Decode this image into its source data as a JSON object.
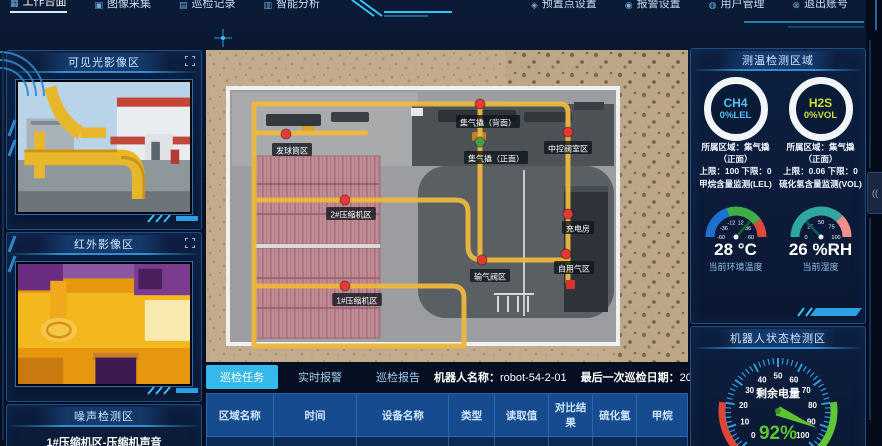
{
  "colors": {
    "accent": "#35c3f5",
    "marker_red": "#e53935",
    "marker_green": "#43a047",
    "path_yellow": "#edb83d",
    "ok_dot": "#8bc34a",
    "ch4": "#4fc3f7",
    "h2s": "#cddc39",
    "battery_green": "#5cc431"
  },
  "nav": {
    "items": [
      {
        "label": "工作台面",
        "icon": "▦",
        "active": true
      },
      {
        "label": "图像采集",
        "icon": "▣",
        "active": false
      },
      {
        "label": "巡检记录",
        "icon": "▤",
        "active": false
      },
      {
        "label": "智能分析",
        "icon": "▥",
        "active": false
      },
      {
        "label": "预置点设置",
        "icon": "◈",
        "active": false
      },
      {
        "label": "报警设置",
        "icon": "◉",
        "active": false
      },
      {
        "label": "用户管理",
        "icon": "◍",
        "active": false
      },
      {
        "label": "退出账号",
        "icon": "⊗",
        "active": false
      }
    ]
  },
  "left": {
    "visible_panel": {
      "title": "可见光影像区",
      "expand_icon": "fullscreen-icon"
    },
    "infrared_panel": {
      "title": "红外影像区",
      "expand_icon": "fullscreen-icon"
    },
    "noise_panel": {
      "title": "噪声检测区",
      "source": "1#压缩机区-压缩机声音"
    }
  },
  "map": {
    "markers": [
      {
        "label": "集气撬（背面）",
        "color": "#e53935",
        "type": "dot",
        "dot": [
          274,
          54
        ],
        "lab": [
          282,
          72
        ]
      },
      {
        "label": "集气撬（正面）",
        "color": "#43a047",
        "type": "dot",
        "dot": [
          274,
          92
        ],
        "lab": [
          290,
          108
        ]
      },
      {
        "label": "中控阀室区",
        "color": "#e53935",
        "type": "dot",
        "dot": [
          362,
          82
        ],
        "lab": [
          362,
          98
        ]
      },
      {
        "label": "发球筒区",
        "color": "#e53935",
        "type": "dot",
        "dot": [
          80,
          84
        ],
        "lab": [
          86,
          100
        ]
      },
      {
        "label": "2#压缩机区",
        "color": "#e53935",
        "type": "dot",
        "dot": [
          139,
          150
        ],
        "lab": [
          145,
          164
        ]
      },
      {
        "label": "1#压缩机区",
        "color": "#e53935",
        "type": "dot",
        "dot": [
          139,
          236
        ],
        "lab": [
          151,
          250
        ]
      },
      {
        "label": "充电房",
        "color": "#e53935",
        "type": "dot",
        "dot": [
          362,
          164
        ],
        "lab": [
          372,
          178
        ]
      },
      {
        "label": "自用气区",
        "color": "#e53935",
        "type": "dot",
        "dot": [
          360,
          204
        ],
        "lab": [
          368,
          218
        ]
      },
      {
        "label": "输气阀区",
        "color": "#e53935",
        "type": "dot",
        "dot": [
          276,
          210
        ],
        "lab": [
          284,
          226
        ]
      },
      {
        "label": "",
        "color": "#d63230",
        "type": "square",
        "dot": [
          364,
          234
        ],
        "lab": [
          0,
          0
        ]
      }
    ]
  },
  "tabs": {
    "items": [
      {
        "label": "巡检任务",
        "active": true
      },
      {
        "label": "实时报警",
        "active": false
      },
      {
        "label": "巡检报告",
        "active": false
      }
    ],
    "robot_name_label": "机器人名称：",
    "robot_name": "robot-54-2-01",
    "last_label": "最后一次巡检日期：",
    "last_date": "2019/6/8 10:07:44"
  },
  "table": {
    "headers": [
      "区域名称",
      "时间",
      "设备名称",
      "类型",
      "读取值",
      "对比结果",
      "硫化氢",
      "甲烷"
    ],
    "rows": [
      {
        "cells": [
          "集气撬（正面）",
          "2019-06-08 10:07:44",
          "集气撬自用气压力表",
          "图像识别",
          "3.38MPa",
          "ok-dot",
          "0",
          "0"
        ]
      }
    ]
  },
  "right": {
    "env_panel": {
      "title": "测温检测区域",
      "gases": [
        {
          "name": "CH4",
          "value": "0%LEL",
          "color": "#4fc3f7",
          "region": "所属区域：集气撬（正面）",
          "limits": "上限：100 下限：0",
          "desc": "甲烷含量监测(LEL)"
        },
        {
          "name": "H2S",
          "value": "0%VOL",
          "color": "#cddc39",
          "region": "所属区域：集气撬（正面）",
          "limits": "上限：0.06 下限：0",
          "desc": "硫化氢含量监测(VOL)"
        }
      ],
      "temp": {
        "ticks": [
          -60,
          -36,
          -12,
          12,
          36,
          60
        ],
        "min": -60,
        "max": 60,
        "value": 28,
        "display": "28 °C",
        "label": "当前环境温度"
      },
      "hum": {
        "ticks": [
          0,
          25,
          50,
          75,
          100
        ],
        "min": 0,
        "max": 100,
        "value": 26,
        "display": "26 %RH",
        "label": "当前湿度"
      }
    },
    "robot_panel": {
      "title": "机器人状态检测区",
      "battery": {
        "label": "剩余电量",
        "display": "92%",
        "value": 92,
        "min": 0,
        "max": 100,
        "ticks": [
          0,
          10,
          20,
          30,
          40,
          50,
          60,
          70,
          80,
          90,
          100
        ]
      }
    }
  },
  "right_edge": {
    "sound_icon": "(("
  }
}
